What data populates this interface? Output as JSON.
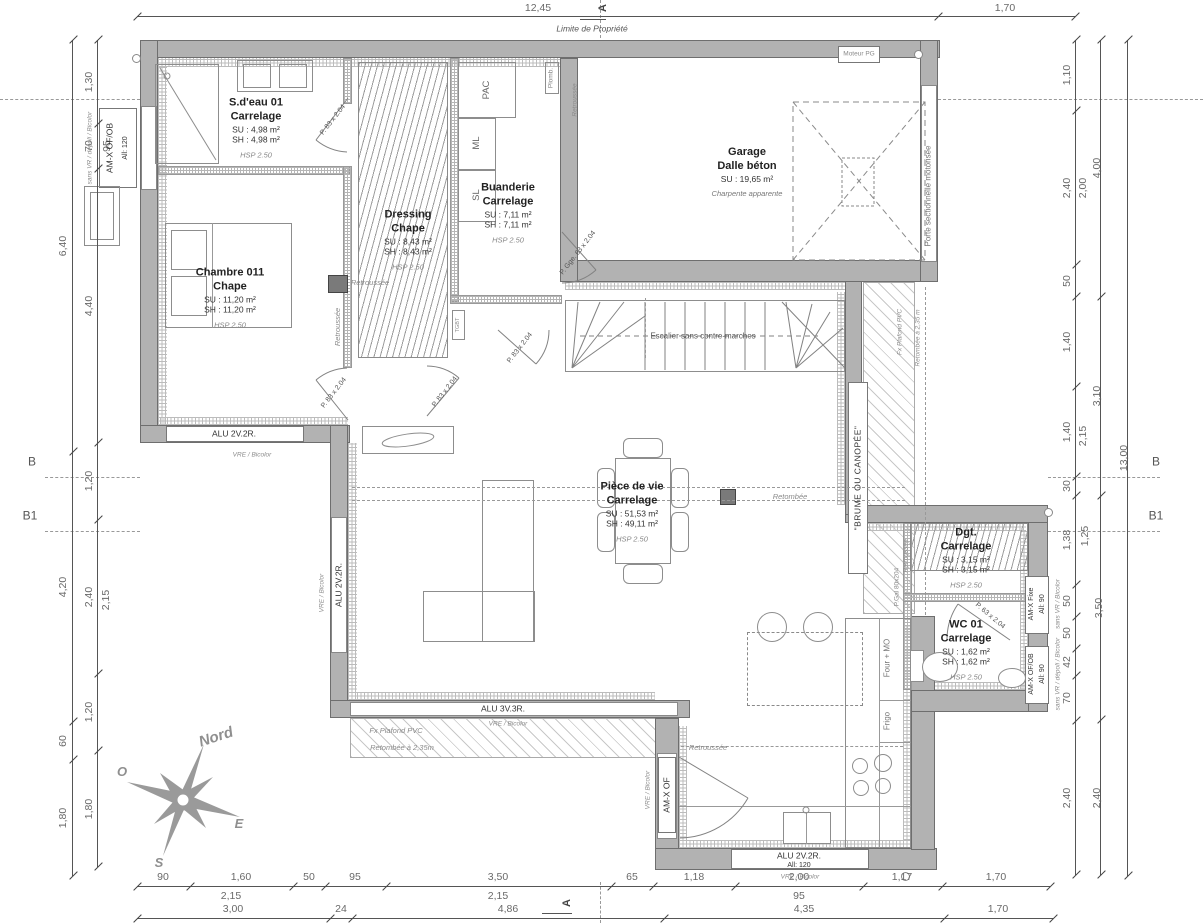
{
  "drawing": {
    "property_line_label": "Limite de Propriété",
    "north_label": "Nord",
    "compass": {
      "o": "O",
      "e": "E",
      "s": "S"
    },
    "sections": {
      "a": "A",
      "b": "B",
      "b1": "B1"
    }
  },
  "rooms": {
    "sdeau": {
      "name": "S.d'eau 01",
      "floor": "Carrelage",
      "su": "SU : 4,98 m²",
      "sh": "SH : 4,98 m²",
      "hsp": "HSP 2.50"
    },
    "chambre": {
      "name": "Chambre 011",
      "floor": "Chape",
      "su": "SU : 11,20 m²",
      "sh": "SH : 11,20 m²",
      "hsp": "HSP 2.50"
    },
    "dressing": {
      "name": "Dressing",
      "floor": "Chape",
      "su": "SU : 8,43 m²",
      "sh": "SH : 8,43 m²",
      "hsp": "HSP 2.50"
    },
    "buanderie": {
      "name": "Buanderie",
      "floor": "Carrelage",
      "su": "SU : 7,11 m²",
      "sh": "SH : 7,11 m²",
      "hsp": "HSP 2.50"
    },
    "garage": {
      "name": "Garage",
      "floor": "Dalle béton",
      "su": "SU : 19,65 m²",
      "note": "Charpente apparente"
    },
    "piecedevie": {
      "name": "Pièce de vie",
      "floor": "Carrelage",
      "su": "SU : 51,53 m²",
      "sh": "SH : 49,11 m²",
      "hsp": "HSP 2.50"
    },
    "dgt": {
      "name": "Dgt.",
      "floor": "Carrelage",
      "su": "SU : 3,15 m²",
      "sh": "SH : 3,15 m²",
      "hsp": "HSP 2.50"
    },
    "wc": {
      "name": "WC 01",
      "floor": "Carrelage",
      "su": "SU : 1,62 m²",
      "sh": "SH : 1,62 m²",
      "hsp": "HSP 2.50"
    }
  },
  "stairs_label": "Escalier sans contre-marches",
  "terrace_label": "\"BRUME OU CANOPÉE\"",
  "equipment": {
    "pac": "PAC",
    "ml": "ML",
    "sl": "SL",
    "plomb": "Plomb.",
    "tgbt": "TGBT",
    "frigo": "Frigo",
    "four": "Four + MO",
    "moteur": "Moteur PG",
    "porte_sectionnelle": "Porte sectionnelle motorisée"
  },
  "openings": {
    "w_left": {
      "label": "AM-X OF/OB",
      "allege": "All: 120",
      "note": "sans VR / dépoli / Bicolor"
    },
    "w_chambre": {
      "label": "ALU 2V.2R.",
      "note": "VRE / Bicolor"
    },
    "w_salon_g": {
      "label": "ALU 2V.2R.",
      "note": "VRE / Bicolor"
    },
    "w_salon_b": {
      "label": "ALU 3V.3R.",
      "note": "VRE / Bicolor"
    },
    "d_cuisine": {
      "label": "AM-X OF",
      "note": "VRE / Bicolor"
    },
    "w_cuisine": {
      "label": "ALU 2V.2R.",
      "allege": "All: 120",
      "note": "VRE / Bicolor"
    },
    "w_dgt": {
      "label": "AM-X Fixe",
      "allege": "All: 90",
      "note": "sans VR / Bicolor"
    },
    "w_wc": {
      "label": "AM-X OF/OB",
      "allege": "All: 90",
      "note": "sans VR / dépoli / Bicolor"
    }
  },
  "doors": {
    "p83": "P. 83 x 2.04",
    "p63": "P. 63 x 2.04",
    "pgge": "P. Gge. 63 x 2.04",
    "pgal": "P.Gal 80x204"
  },
  "annotations": {
    "retroussee": "Retroussée",
    "retombee": "Retombée",
    "fx_plafond_pvc": "Fx Plafond PVC",
    "retombee_235": "Retombée à 2,35 m",
    "retombee_235b": "Retombée à 2,35m"
  },
  "dims": {
    "d1245": "12,45",
    "d170": "1,70",
    "d90": "90",
    "d160": "1,60",
    "d50": "50",
    "d95": "95",
    "d350": "3,50",
    "d65": "65",
    "d118": "1,18",
    "d200": "2,00",
    "d117": "1,17",
    "d215": "2,15",
    "d300": "3,00",
    "d24": "24",
    "d486": "4,86",
    "d435": "4,35",
    "d130": "1,30",
    "d70": "70",
    "d440": "4,40",
    "d120": "1,20",
    "d240": "2,40",
    "d180": "1,80",
    "d640": "6,40",
    "d420": "4,20",
    "d60": "60",
    "d110": "1,10",
    "d140": "1,40",
    "d30": "30",
    "d138": "1,38",
    "d42": "42",
    "d400": "4,00",
    "d310": "3,10",
    "d125": "1,25",
    "d1300": "13,00"
  }
}
